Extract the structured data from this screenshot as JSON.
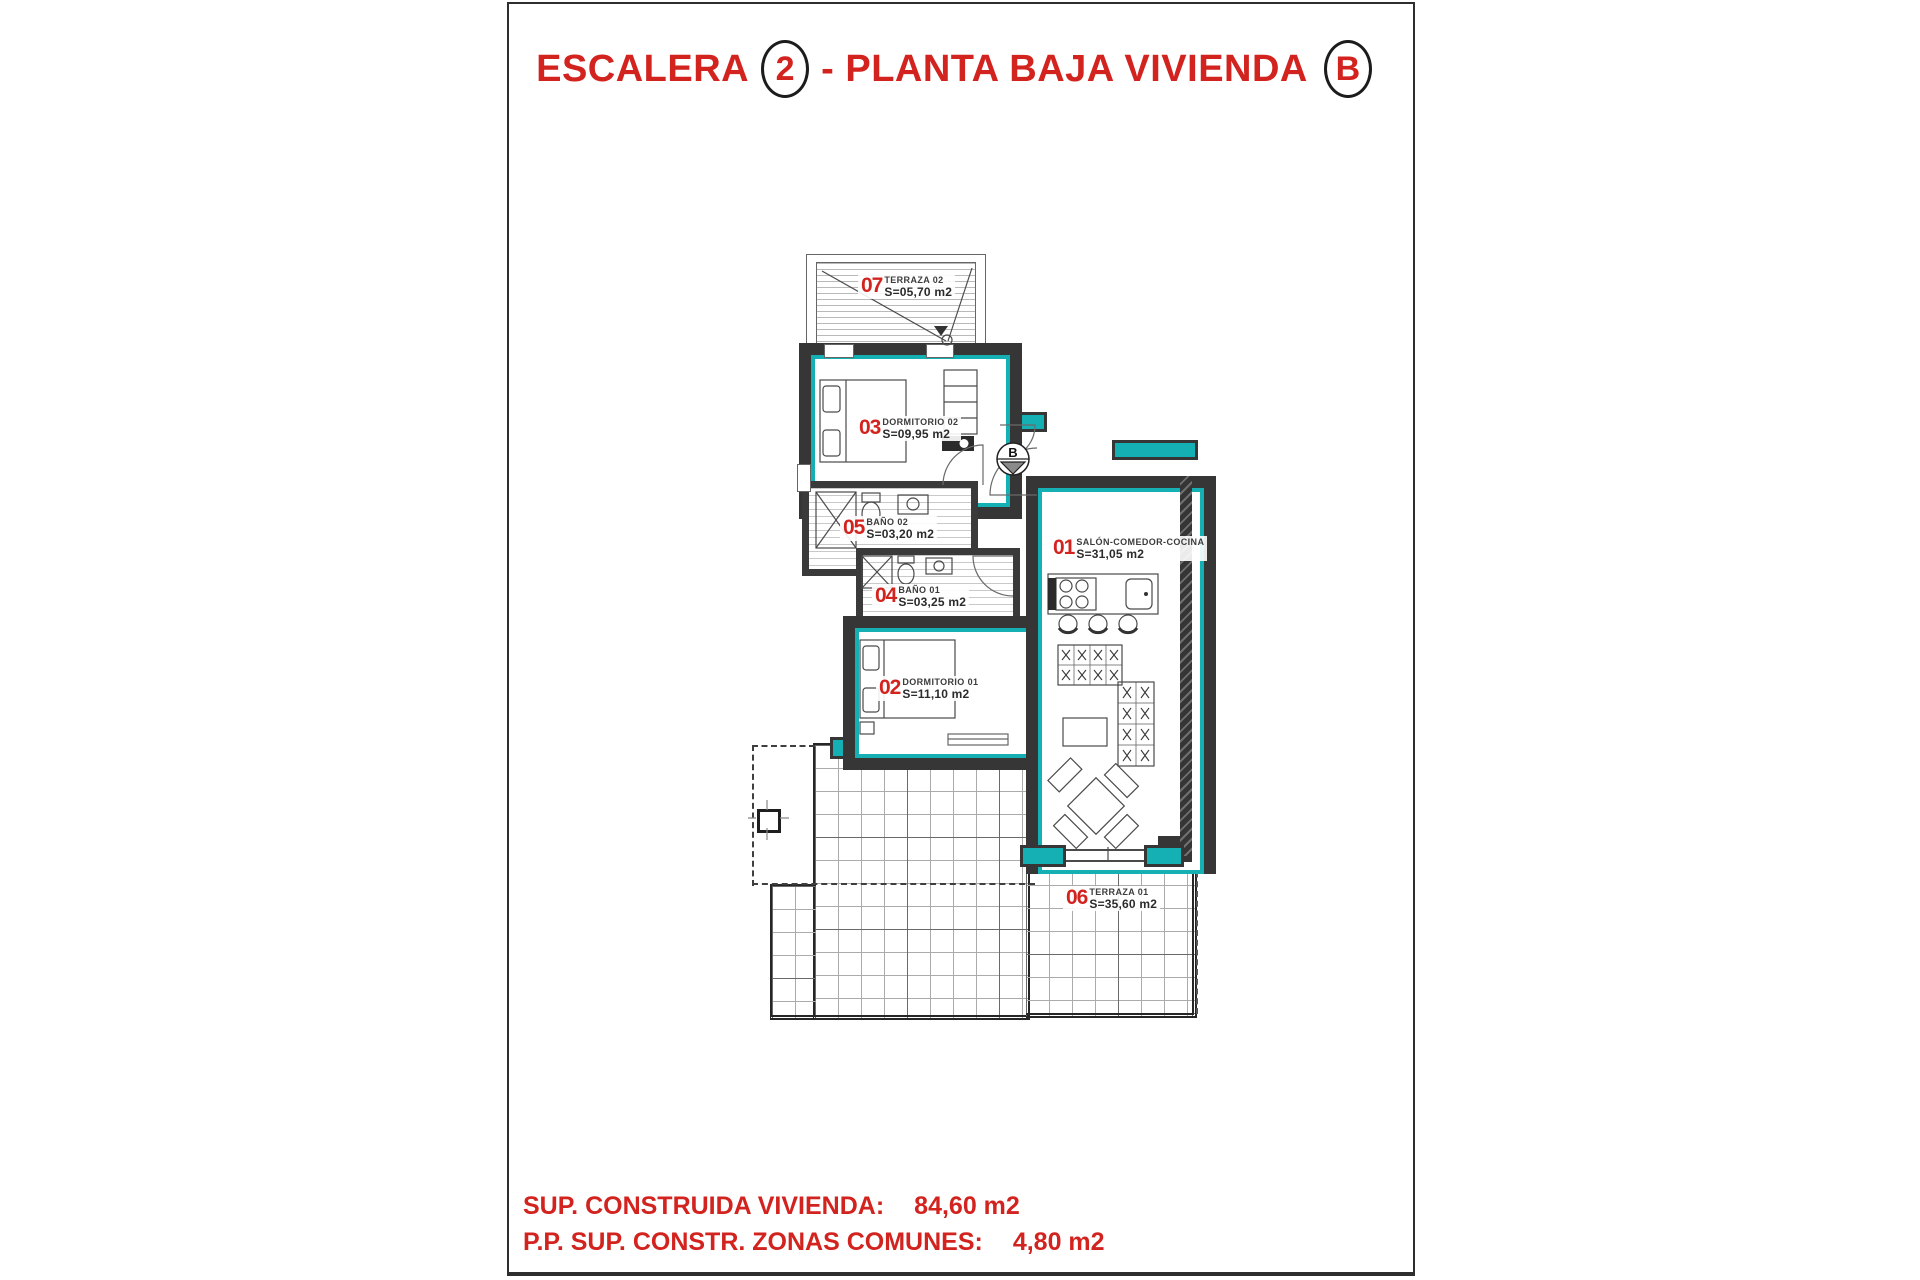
{
  "title": {
    "word1": "ESCALERA",
    "stair_number": "2",
    "word2": "- PLANTA BAJA VIVIENDA",
    "unit_letter": "B"
  },
  "rooms": [
    {
      "number": "01",
      "name": "SALÓN-COMEDOR-COCINA",
      "area": "S=31,05 m2"
    },
    {
      "number": "02",
      "name": "DORMITORIO 01",
      "area": "S=11,10 m2"
    },
    {
      "number": "03",
      "name": "DORMITORIO 02",
      "area": "S=09,95 m2"
    },
    {
      "number": "04",
      "name": "BAÑO 01",
      "area": "S=03,25 m2"
    },
    {
      "number": "05",
      "name": "BAÑO 02",
      "area": "S=03,20 m2"
    },
    {
      "number": "06",
      "name": "TERRAZA 01",
      "area": "S=35,60 m2"
    },
    {
      "number": "07",
      "name": "TERRAZA 02",
      "area": "S=05,70 m2"
    }
  ],
  "stair_marker": {
    "letter": "B"
  },
  "footer": {
    "line1_label": "SUP. CONSTRUIDA VIVIENDA:",
    "line1_value": "84,60 m2",
    "line2_label": "P.P. SUP. CONSTR. ZONAS COMUNES:",
    "line2_value": "4,80 m2"
  },
  "colors": {
    "accent_red": "#d2231f",
    "wall_dark": "#363636",
    "insulation_teal": "#14b0b4"
  }
}
